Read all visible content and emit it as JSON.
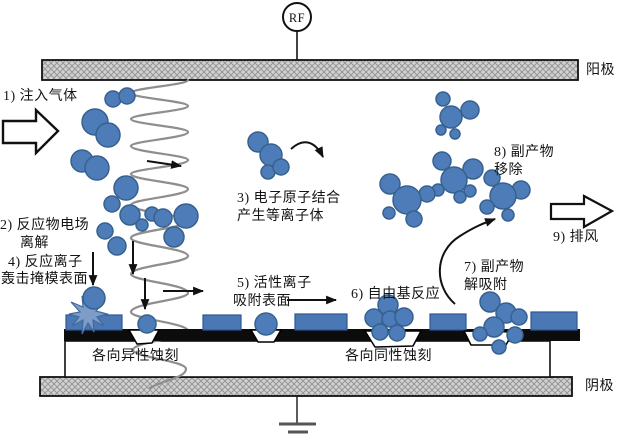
{
  "diagram": {
    "type": "RF plasma etching process schematic",
    "rf_label": "RF",
    "electrodes": {
      "anode": "阳极",
      "cathode": "阴极"
    },
    "steps": {
      "step1": "1) 注入气体",
      "step2_line1": "2) 反应物电场",
      "step2_line2": "离解",
      "step3_line1": "3) 电子原子结合",
      "step3_line2": "产生等离子体",
      "step4_line1": "4) 反应离子",
      "step4_line2": "轰击掩模表面",
      "step5_line1": "5) 活性离子",
      "step5_line2": "吸附表面",
      "step6": "6) 自由基反应",
      "step7_line1": "7) 副产物",
      "step7_line2": "解吸附",
      "step8_line1": "8) 副产物",
      "step8_line2": "移除",
      "step9": "9) 排风"
    },
    "etch_labels": {
      "anisotropic": "各向异性蚀刻",
      "isotropic": "各向同性蚀刻"
    },
    "colors": {
      "molecule_fill": "#4d7cb8",
      "molecule_stroke": "#36618f",
      "mask_fill": "#4a78b4",
      "starburst_fill": "#7e9cc8",
      "electrode_fill": "#d2d2d2",
      "substrate": "#0c0c0c",
      "field_wave": "#8e8e8e"
    }
  }
}
